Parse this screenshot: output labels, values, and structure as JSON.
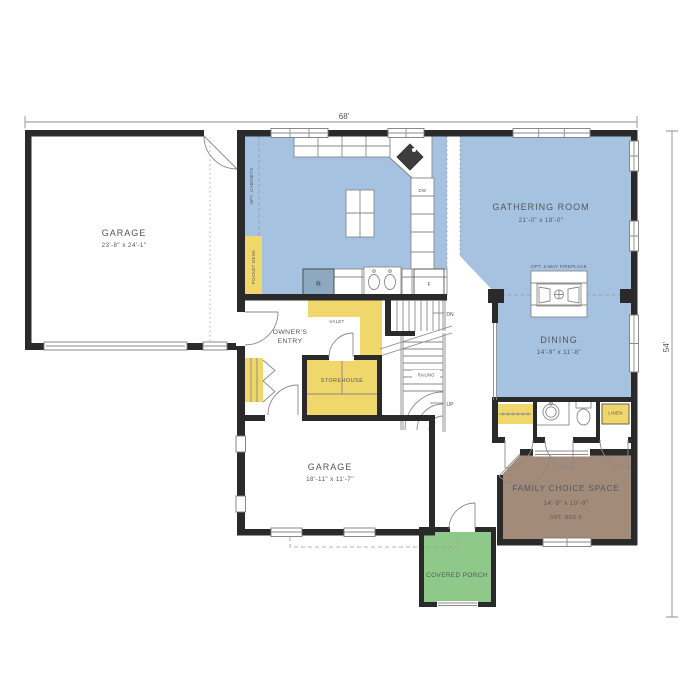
{
  "plan": {
    "dim_top": "68'",
    "dim_right": "54'",
    "rooms": {
      "garage_main": {
        "name": "GARAGE",
        "dims": "23'-8\" x 24'-1\""
      },
      "gathering": {
        "name": "GATHERING ROOM",
        "dims": "21'-0\" x 18'-0\""
      },
      "dining": {
        "name": "DINING",
        "dims": "14'-9\" x 11'-8\""
      },
      "garage_small": {
        "name": "GARAGE",
        "dims": "18'-11\" x 11'-7\""
      },
      "family": {
        "name": "FAMILY CHOICE SPACE",
        "dims": "14'-9\" x 10'-9\"",
        "note": "OPT. BED 5"
      },
      "porch": {
        "name": "COVERED PORCH"
      },
      "owners_entry": {
        "line1": "OWNER'S",
        "line2": "ENTRY"
      },
      "storehouse": {
        "name": "STOREHOUSE"
      }
    },
    "labels": {
      "valet": "VALET",
      "pocket_desk": "POCKET DESK",
      "opt_cabinets": "OPT. CABINETS",
      "fireplace": "OPT. 2-WAY FIREPLACE",
      "linen": "LINEN",
      "dishwasher": "DW",
      "range": "R",
      "refrigerator": "F",
      "down": "DN",
      "up": "UP",
      "railing": "RAILING"
    },
    "colors": {
      "room_blue": "#a5c2e1",
      "cabinet_yellow": "#efd76b",
      "family_brown": "#a28b79",
      "porch_green": "#8fc98a",
      "wall": "#2b2a2a",
      "text": "#55565a"
    }
  }
}
